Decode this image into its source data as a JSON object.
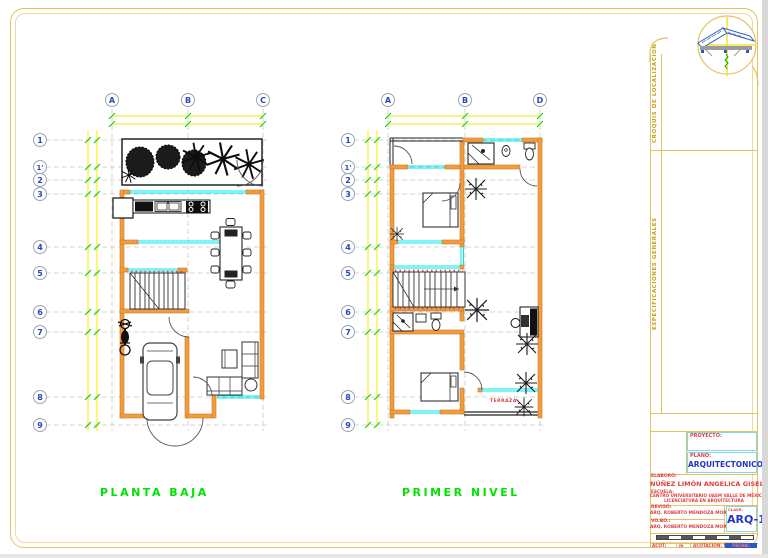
{
  "sheet": {
    "plans": [
      {
        "label": "PLANTA BAJA",
        "cols": [
          "A",
          "B",
          "C"
        ],
        "rows": [
          "1",
          "1'",
          "2",
          "3",
          "4",
          "5",
          "6",
          "7",
          "8",
          "9"
        ]
      },
      {
        "label": "PRIMER NIVEL",
        "cols": [
          "A",
          "B",
          "D"
        ],
        "rows": [
          "1",
          "1'",
          "2",
          "3",
          "4",
          "5",
          "6",
          "7",
          "8",
          "9"
        ],
        "room_label": "TERRAZA"
      }
    ],
    "sidebar": {
      "croquis": "CROQUIS DE LOCALIZACION",
      "especificaciones": "ESPECIFICACIONES GENERALES"
    },
    "titleblock": {
      "owner_label": "PROYECTO:",
      "plano_label": "PLANO:",
      "plano_value": "ARQUITECTONICO",
      "author_label": "ELABORÓ:",
      "author_value": "NÚÑEZ LIMÓN ANGELICA GISELL",
      "school_label": "ESCUELA:",
      "school_line1": "CENTRO UNIVERSITARIO UAEM VALLE DE MÉXICO",
      "school_line2": "LICENCIATURA EN ARQUITECTURA",
      "reviso_label": "REVISÓ:",
      "reviso_value": "ARQ. ROBERTO MENDOZA MORALES",
      "vobo_label": "VO.BO.:",
      "vobo_value": "ARQ. ROBERTO MENDOZA MORALES",
      "clave_label": "CLAVE:",
      "clave_value": "ARQ-1",
      "bottom_acot_label": "ACOT:",
      "bottom_acot_unit": "m",
      "bottom_mid": "ACOTACION: METROS",
      "bottom_fecha": "FECHA:"
    },
    "colors": {
      "wall_orange": "#f29b3f",
      "window_cyan": "#00e8e8",
      "dimension_yellow": "#f6ea00",
      "tick_green": "#17d317",
      "label_green": "#00e400",
      "accent_red": "#e04040",
      "accent_blue": "#2233cc",
      "border_gold": "#e4c262"
    }
  }
}
